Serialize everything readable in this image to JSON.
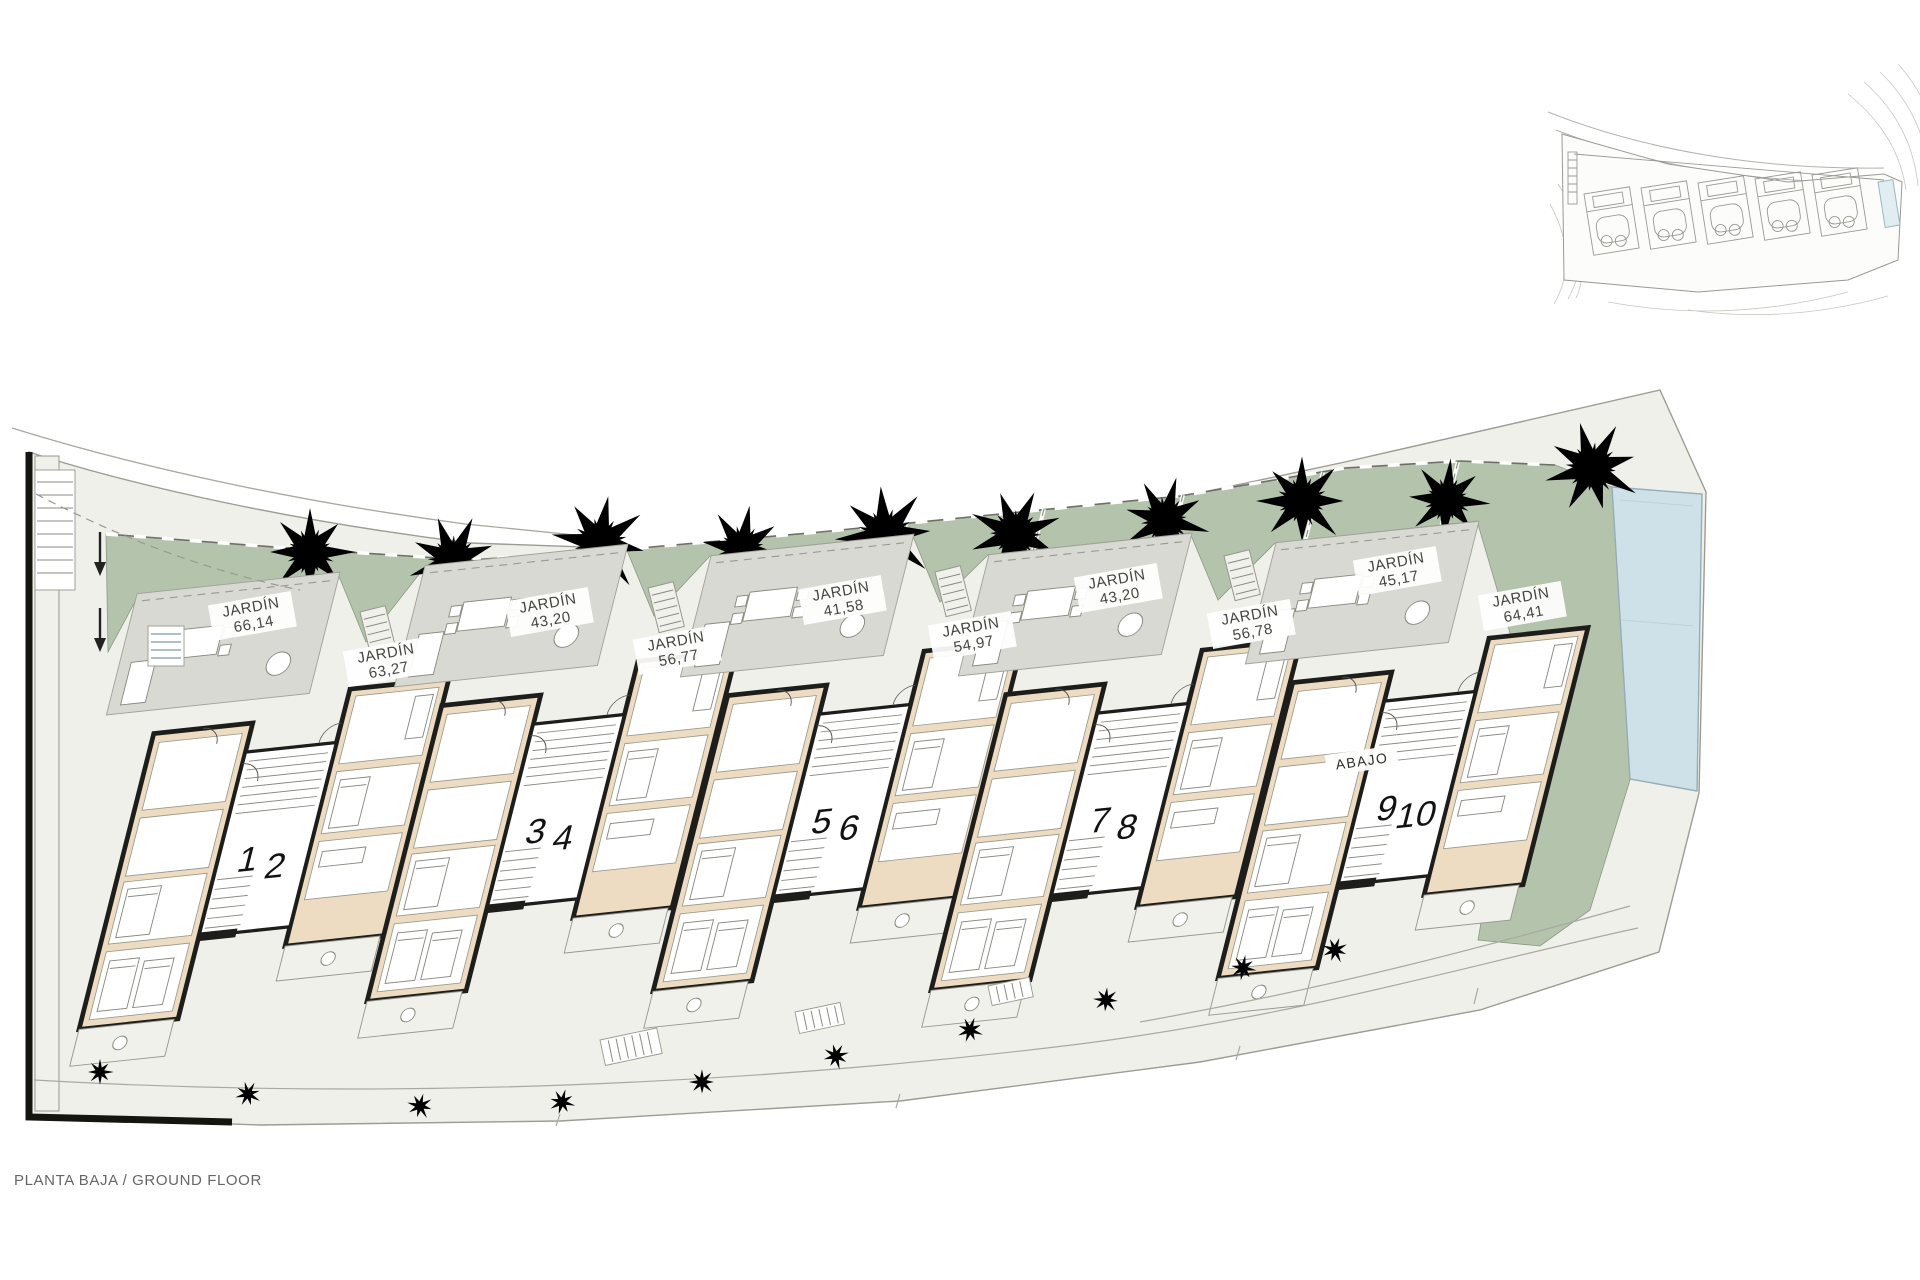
{
  "meta": {
    "floor_label": "PLANTA BAJA / GROUND FLOOR"
  },
  "gardens": [
    {
      "label": "JARDÍN",
      "area": "66,14"
    },
    {
      "label": "JARDÍN",
      "area": "63,27"
    },
    {
      "label": "JARDÍN",
      "area": "43,20"
    },
    {
      "label": "JARDÍN",
      "area": "56,77"
    },
    {
      "label": "JARDÍN",
      "area": "41,58"
    },
    {
      "label": "JARDÍN",
      "area": "54,97"
    },
    {
      "label": "JARDÍN",
      "area": "43,20"
    },
    {
      "label": "JARDÍN",
      "area": "56,78"
    },
    {
      "label": "JARDÍN",
      "area": "45,17"
    },
    {
      "label": "JARDÍN",
      "area": "64,41"
    }
  ],
  "units": [
    "1",
    "2",
    "3",
    "4",
    "5",
    "6",
    "7",
    "8",
    "9",
    "10"
  ],
  "annotations": {
    "abajo": "ABAJO"
  },
  "colors": {
    "garden_green": "#b4c3ab",
    "building_tan": "#eddcc1",
    "terrace_grey": "#d8d9d3",
    "site_grey": "#f0f0eb",
    "pool_blue": "#cfe1e8",
    "wall_black": "#1d1d1b"
  }
}
